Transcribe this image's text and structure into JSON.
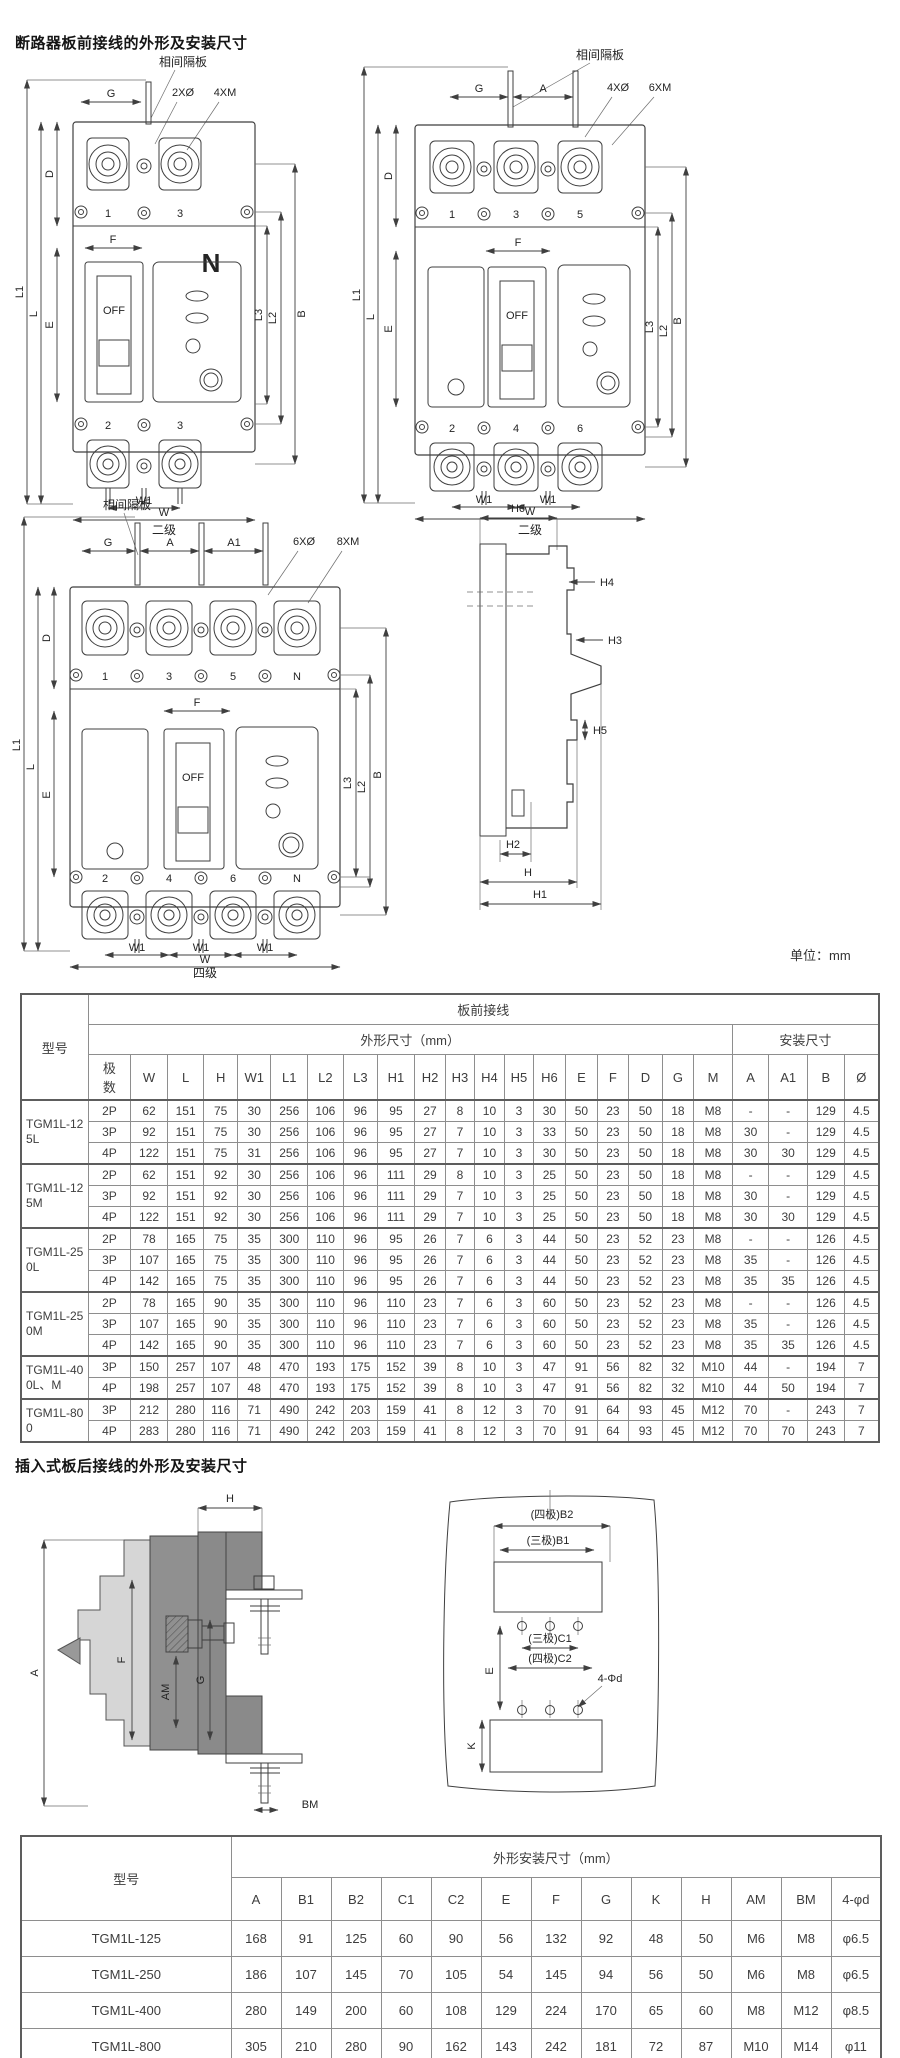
{
  "page": {
    "title_front": "断路器板前接线的外形及安装尺寸",
    "title_plugin": "插入式板后接线的外形及安装尺寸",
    "unit_note": "单位：mm"
  },
  "labels": {
    "partition": "相间隔板",
    "g": "G",
    "a": "A",
    "a1": "A1",
    "holes2": "2XØ",
    "holes4": "4XØ",
    "holes6": "6XØ",
    "screws4": "4XM",
    "screws6": "6XM",
    "screws8": "8XM",
    "n": "N",
    "off": "OFF",
    "f": "F",
    "d": "D",
    "e": "E",
    "l": "L",
    "l1": "L1",
    "l2": "L2",
    "l3": "L3",
    "b": "B",
    "w": "W",
    "w1": "W1",
    "t1": "1",
    "t2": "2",
    "t3": "3",
    "t4": "4",
    "t5": "5",
    "t6": "6",
    "caption_2p": "二级",
    "caption_3p": "二级",
    "caption_4p": "四级",
    "h": "H",
    "h1": "H1",
    "h2": "H2",
    "h3": "H3",
    "h4": "H4",
    "h5": "H5",
    "h6": "H6",
    "am": "AM",
    "bm": "BM",
    "k": "K",
    "b1_3p": "(三极)B1",
    "b2_4p": "(四极)B2",
    "c1_3p": "(三极)C1",
    "c2_4p": "(四极)C2",
    "hole_spec": "4-Φd"
  },
  "table1": {
    "col_model": "型号",
    "group_header": "板前接线",
    "dim_header": "外形尺寸（mm）",
    "install_header": "安装尺寸",
    "col_poles": "极数",
    "dim_cols": [
      "W",
      "L",
      "H",
      "W1",
      "L1",
      "L2",
      "L3",
      "H1",
      "H2",
      "H3",
      "H4",
      "H5",
      "H6",
      "E",
      "F",
      "D",
      "G",
      "M"
    ],
    "install_cols": [
      "A",
      "A1",
      "B",
      "Ø"
    ],
    "groups": [
      {
        "model": "TGM1L-125L",
        "rows": [
          {
            "poles": "2P",
            "values": [
              "62",
              "151",
              "75",
              "30",
              "256",
              "106",
              "96",
              "95",
              "27",
              "8",
              "10",
              "3",
              "30",
              "50",
              "23",
              "50",
              "18",
              "M8",
              "-",
              "-",
              "129",
              "4.5"
            ]
          },
          {
            "poles": "3P",
            "values": [
              "92",
              "151",
              "75",
              "30",
              "256",
              "106",
              "96",
              "95",
              "27",
              "7",
              "10",
              "3",
              "33",
              "50",
              "23",
              "50",
              "18",
              "M8",
              "30",
              "-",
              "129",
              "4.5"
            ]
          },
          {
            "poles": "4P",
            "values": [
              "122",
              "151",
              "75",
              "31",
              "256",
              "106",
              "96",
              "95",
              "27",
              "7",
              "10",
              "3",
              "30",
              "50",
              "23",
              "50",
              "18",
              "M8",
              "30",
              "30",
              "129",
              "4.5"
            ]
          }
        ]
      },
      {
        "model": "TGM1L-125M",
        "rows": [
          {
            "poles": "2P",
            "values": [
              "62",
              "151",
              "92",
              "30",
              "256",
              "106",
              "96",
              "111",
              "29",
              "8",
              "10",
              "3",
              "25",
              "50",
              "23",
              "50",
              "18",
              "M8",
              "-",
              "-",
              "129",
              "4.5"
            ]
          },
          {
            "poles": "3P",
            "values": [
              "92",
              "151",
              "92",
              "30",
              "256",
              "106",
              "96",
              "111",
              "29",
              "7",
              "10",
              "3",
              "25",
              "50",
              "23",
              "50",
              "18",
              "M8",
              "30",
              "-",
              "129",
              "4.5"
            ]
          },
          {
            "poles": "4P",
            "values": [
              "122",
              "151",
              "92",
              "30",
              "256",
              "106",
              "96",
              "111",
              "29",
              "7",
              "10",
              "3",
              "25",
              "50",
              "23",
              "50",
              "18",
              "M8",
              "30",
              "30",
              "129",
              "4.5"
            ]
          }
        ]
      },
      {
        "model": "TGM1L-250L",
        "rows": [
          {
            "poles": "2P",
            "values": [
              "78",
              "165",
              "75",
              "35",
              "300",
              "110",
              "96",
              "95",
              "26",
              "7",
              "6",
              "3",
              "44",
              "50",
              "23",
              "52",
              "23",
              "M8",
              "-",
              "-",
              "126",
              "4.5"
            ]
          },
          {
            "poles": "3P",
            "values": [
              "107",
              "165",
              "75",
              "35",
              "300",
              "110",
              "96",
              "95",
              "26",
              "7",
              "6",
              "3",
              "44",
              "50",
              "23",
              "52",
              "23",
              "M8",
              "35",
              "-",
              "126",
              "4.5"
            ]
          },
          {
            "poles": "4P",
            "values": [
              "142",
              "165",
              "75",
              "35",
              "300",
              "110",
              "96",
              "95",
              "26",
              "7",
              "6",
              "3",
              "44",
              "50",
              "23",
              "52",
              "23",
              "M8",
              "35",
              "35",
              "126",
              "4.5"
            ]
          }
        ]
      },
      {
        "model": "TGM1L-250M",
        "rows": [
          {
            "poles": "2P",
            "values": [
              "78",
              "165",
              "90",
              "35",
              "300",
              "110",
              "96",
              "110",
              "23",
              "7",
              "6",
              "3",
              "60",
              "50",
              "23",
              "52",
              "23",
              "M8",
              "-",
              "-",
              "126",
              "4.5"
            ]
          },
          {
            "poles": "3P",
            "values": [
              "107",
              "165",
              "90",
              "35",
              "300",
              "110",
              "96",
              "110",
              "23",
              "7",
              "6",
              "3",
              "60",
              "50",
              "23",
              "52",
              "23",
              "M8",
              "35",
              "-",
              "126",
              "4.5"
            ]
          },
          {
            "poles": "4P",
            "values": [
              "142",
              "165",
              "90",
              "35",
              "300",
              "110",
              "96",
              "110",
              "23",
              "7",
              "6",
              "3",
              "60",
              "50",
              "23",
              "52",
              "23",
              "M8",
              "35",
              "35",
              "126",
              "4.5"
            ]
          }
        ]
      },
      {
        "model": "TGM1L-400L、M",
        "rows": [
          {
            "poles": "3P",
            "values": [
              "150",
              "257",
              "107",
              "48",
              "470",
              "193",
              "175",
              "152",
              "39",
              "8",
              "10",
              "3",
              "47",
              "91",
              "56",
              "82",
              "32",
              "M10",
              "44",
              "-",
              "194",
              "7"
            ]
          },
          {
            "poles": "4P",
            "values": [
              "198",
              "257",
              "107",
              "48",
              "470",
              "193",
              "175",
              "152",
              "39",
              "8",
              "10",
              "3",
              "47",
              "91",
              "56",
              "82",
              "32",
              "M10",
              "44",
              "50",
              "194",
              "7"
            ]
          }
        ]
      },
      {
        "model": "TGM1L-800",
        "rows": [
          {
            "poles": "3P",
            "values": [
              "212",
              "280",
              "116",
              "71",
              "490",
              "242",
              "203",
              "159",
              "41",
              "8",
              "12",
              "3",
              "70",
              "91",
              "64",
              "93",
              "45",
              "M12",
              "70",
              "-",
              "243",
              "7"
            ]
          },
          {
            "poles": "4P",
            "values": [
              "283",
              "280",
              "116",
              "71",
              "490",
              "242",
              "203",
              "159",
              "41",
              "8",
              "12",
              "3",
              "70",
              "91",
              "64",
              "93",
              "45",
              "M12",
              "70",
              "70",
              "243",
              "7"
            ]
          }
        ]
      }
    ]
  },
  "table2": {
    "col_model": "型号",
    "header": "外形安装尺寸（mm）",
    "cols": [
      "A",
      "B1",
      "B2",
      "C1",
      "C2",
      "E",
      "F",
      "G",
      "K",
      "H",
      "AM",
      "BM",
      "4-φd"
    ],
    "rows": [
      {
        "model": "TGM1L-125",
        "values": [
          "168",
          "91",
          "125",
          "60",
          "90",
          "56",
          "132",
          "92",
          "48",
          "50",
          "M6",
          "M8",
          "φ6.5"
        ]
      },
      {
        "model": "TGM1L-250",
        "values": [
          "186",
          "107",
          "145",
          "70",
          "105",
          "54",
          "145",
          "94",
          "56",
          "50",
          "M6",
          "M8",
          "φ6.5"
        ]
      },
      {
        "model": "TGM1L-400",
        "values": [
          "280",
          "149",
          "200",
          "60",
          "108",
          "129",
          "224",
          "170",
          "65",
          "60",
          "M8",
          "M12",
          "φ8.5"
        ]
      },
      {
        "model": "TGM1L-800",
        "values": [
          "305",
          "210",
          "280",
          "90",
          "162",
          "143",
          "242",
          "181",
          "72",
          "87",
          "M10",
          "M14",
          "φ11"
        ]
      }
    ]
  }
}
